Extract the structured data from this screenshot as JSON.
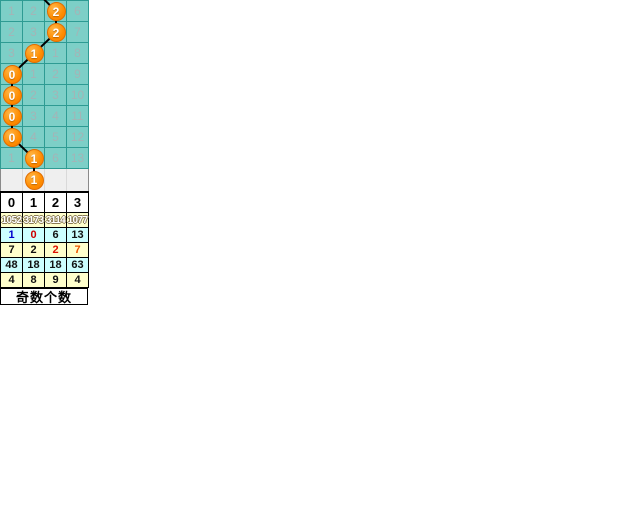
{
  "page_title": "奇数个数走势",
  "colors": {
    "grid_bg": "#7DCFC7",
    "grid_line": "#2E9B93",
    "grid_text": "#A4B4B6",
    "ball_fill": "#FF8C00",
    "ball_text": "#FFFFFF",
    "connector_line": "#000000",
    "pending_bg": "#EFEFEF",
    "stats_yellow": "#FFFFCC",
    "stats_cyan": "#CCFFFF",
    "header_bg": "#FFFFFF"
  },
  "footer": {
    "title": "奇数个数"
  },
  "chart_data": {
    "type": "table",
    "title": "奇数个数",
    "columns": [
      "0",
      "1",
      "2",
      "3"
    ],
    "trend_rows": [
      {
        "miss": [
          "1",
          "2",
          "",
          "6"
        ],
        "hit_col": 2,
        "hit_value": "2"
      },
      {
        "miss": [
          "2",
          "3",
          "",
          "7"
        ],
        "hit_col": 2,
        "hit_value": "2"
      },
      {
        "miss": [
          "3",
          "",
          "1",
          "8"
        ],
        "hit_col": 1,
        "hit_value": "1"
      },
      {
        "miss": [
          "",
          "1",
          "2",
          "9"
        ],
        "hit_col": 0,
        "hit_value": "0"
      },
      {
        "miss": [
          "",
          "2",
          "3",
          "10"
        ],
        "hit_col": 0,
        "hit_value": "0"
      },
      {
        "miss": [
          "",
          "3",
          "4",
          "11"
        ],
        "hit_col": 0,
        "hit_value": "0"
      },
      {
        "miss": [
          "",
          "4",
          "5",
          "12"
        ],
        "hit_col": 0,
        "hit_value": "0"
      },
      {
        "miss": [
          "1",
          "",
          "6",
          "13"
        ],
        "hit_col": 1,
        "hit_value": "1"
      }
    ],
    "pending_row": {
      "hit_col": 1,
      "hit_value": "1"
    },
    "incoming_line_col": 1,
    "stats_rows": [
      {
        "bg": "#FFFFCC",
        "outlined": true,
        "values": [
          "1052",
          "3173",
          "3114",
          "1077"
        ],
        "text_colors": [
          "#FFFFFF",
          "#FFFFFF",
          "#FFFFFF",
          "#FFFFFF"
        ]
      },
      {
        "bg": "#CCFFFF",
        "outlined": false,
        "values": [
          "1",
          "0",
          "6",
          "13"
        ],
        "text_colors": [
          "#0000CC",
          "#CC0000",
          "#111111",
          "#111111"
        ]
      },
      {
        "bg": "#FFFFCC",
        "outlined": false,
        "values": [
          "7",
          "2",
          "2",
          "7"
        ],
        "text_colors": [
          "#111111",
          "#111111",
          "#DD1100",
          "#EE5500"
        ]
      },
      {
        "bg": "#CCFFFF",
        "outlined": false,
        "values": [
          "48",
          "18",
          "18",
          "63"
        ],
        "text_colors": [
          "#111111",
          "#111111",
          "#111111",
          "#111111"
        ]
      },
      {
        "bg": "#FFFFCC",
        "outlined": false,
        "values": [
          "4",
          "8",
          "9",
          "4"
        ],
        "text_colors": [
          "#111111",
          "#111111",
          "#111111",
          "#111111"
        ]
      }
    ]
  },
  "layout": {
    "cell_w": 22,
    "cell_h": 21,
    "pending_h": 22,
    "ball_d": 19
  }
}
